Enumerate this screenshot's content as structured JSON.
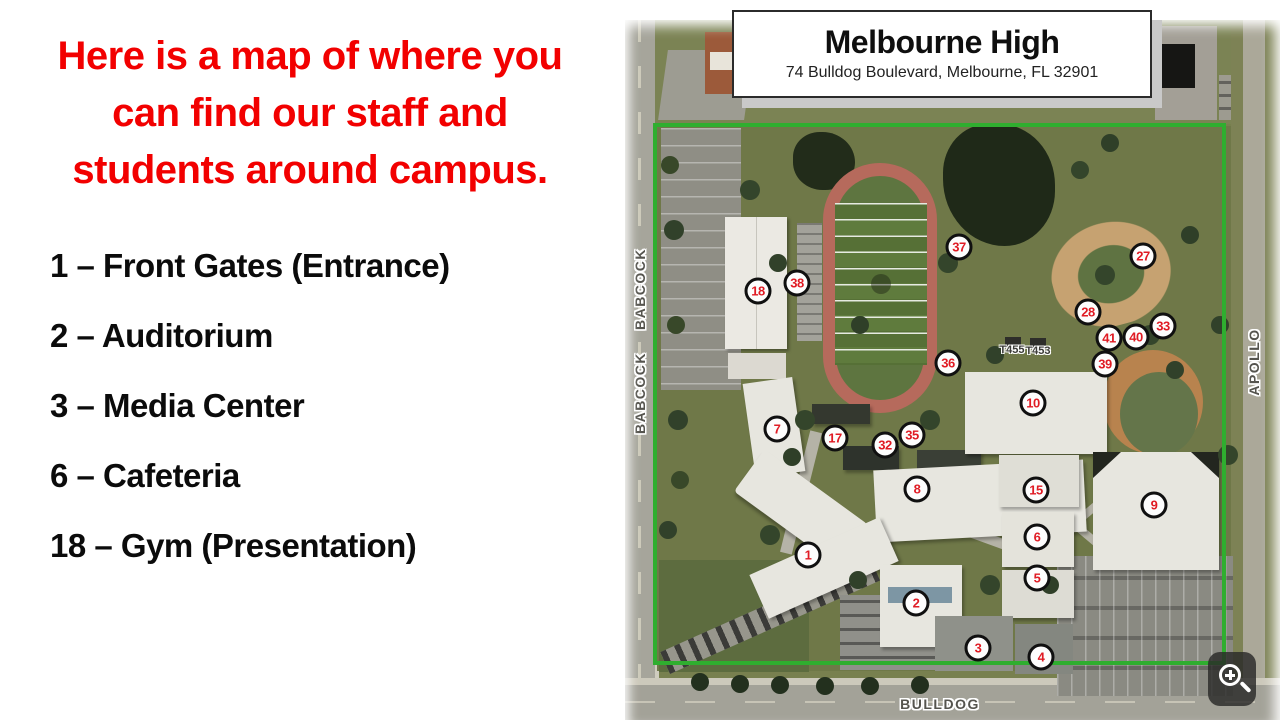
{
  "heading": {
    "lines": [
      "Here is a map of where you",
      "can find our staff and",
      "students around campus."
    ],
    "color": "#f20000"
  },
  "legend": {
    "items": [
      "1 – Front Gates (Entrance)",
      "2 – Auditorium",
      "3 – Media Center",
      "6 – Cafeteria",
      "18 – Gym (Presentation)"
    ]
  },
  "map": {
    "school_name": "Melbourne High",
    "address": "74 Bulldog Boulevard, Melbourne, FL 32901",
    "streets": {
      "left_top": "BABCOCK",
      "left_bottom": "BABCOCK",
      "right": "APOLLO",
      "bottom": "BULLDOG"
    },
    "portables": [
      "T455",
      "T453"
    ],
    "boundary_color": "#2fae2f",
    "marker_number_color": "#e01b24",
    "markers": [
      {
        "n": "18",
        "x": 133,
        "y": 271
      },
      {
        "n": "38",
        "x": 172,
        "y": 263
      },
      {
        "n": "37",
        "x": 334,
        "y": 227
      },
      {
        "n": "27",
        "x": 518,
        "y": 236
      },
      {
        "n": "28",
        "x": 463,
        "y": 292
      },
      {
        "n": "33",
        "x": 538,
        "y": 306
      },
      {
        "n": "41",
        "x": 484,
        "y": 318
      },
      {
        "n": "40",
        "x": 511,
        "y": 317
      },
      {
        "n": "39",
        "x": 480,
        "y": 344
      },
      {
        "n": "36",
        "x": 323,
        "y": 343
      },
      {
        "n": "10",
        "x": 408,
        "y": 383
      },
      {
        "n": "7",
        "x": 152,
        "y": 409
      },
      {
        "n": "17",
        "x": 210,
        "y": 418
      },
      {
        "n": "32",
        "x": 260,
        "y": 425
      },
      {
        "n": "35",
        "x": 287,
        "y": 415
      },
      {
        "n": "8",
        "x": 292,
        "y": 469
      },
      {
        "n": "15",
        "x": 411,
        "y": 470
      },
      {
        "n": "9",
        "x": 529,
        "y": 485
      },
      {
        "n": "6",
        "x": 412,
        "y": 517
      },
      {
        "n": "5",
        "x": 412,
        "y": 558
      },
      {
        "n": "1",
        "x": 183,
        "y": 535
      },
      {
        "n": "2",
        "x": 291,
        "y": 583
      },
      {
        "n": "3",
        "x": 353,
        "y": 628
      },
      {
        "n": "4",
        "x": 416,
        "y": 637
      }
    ],
    "zoom_control": "magnifier-plus"
  }
}
